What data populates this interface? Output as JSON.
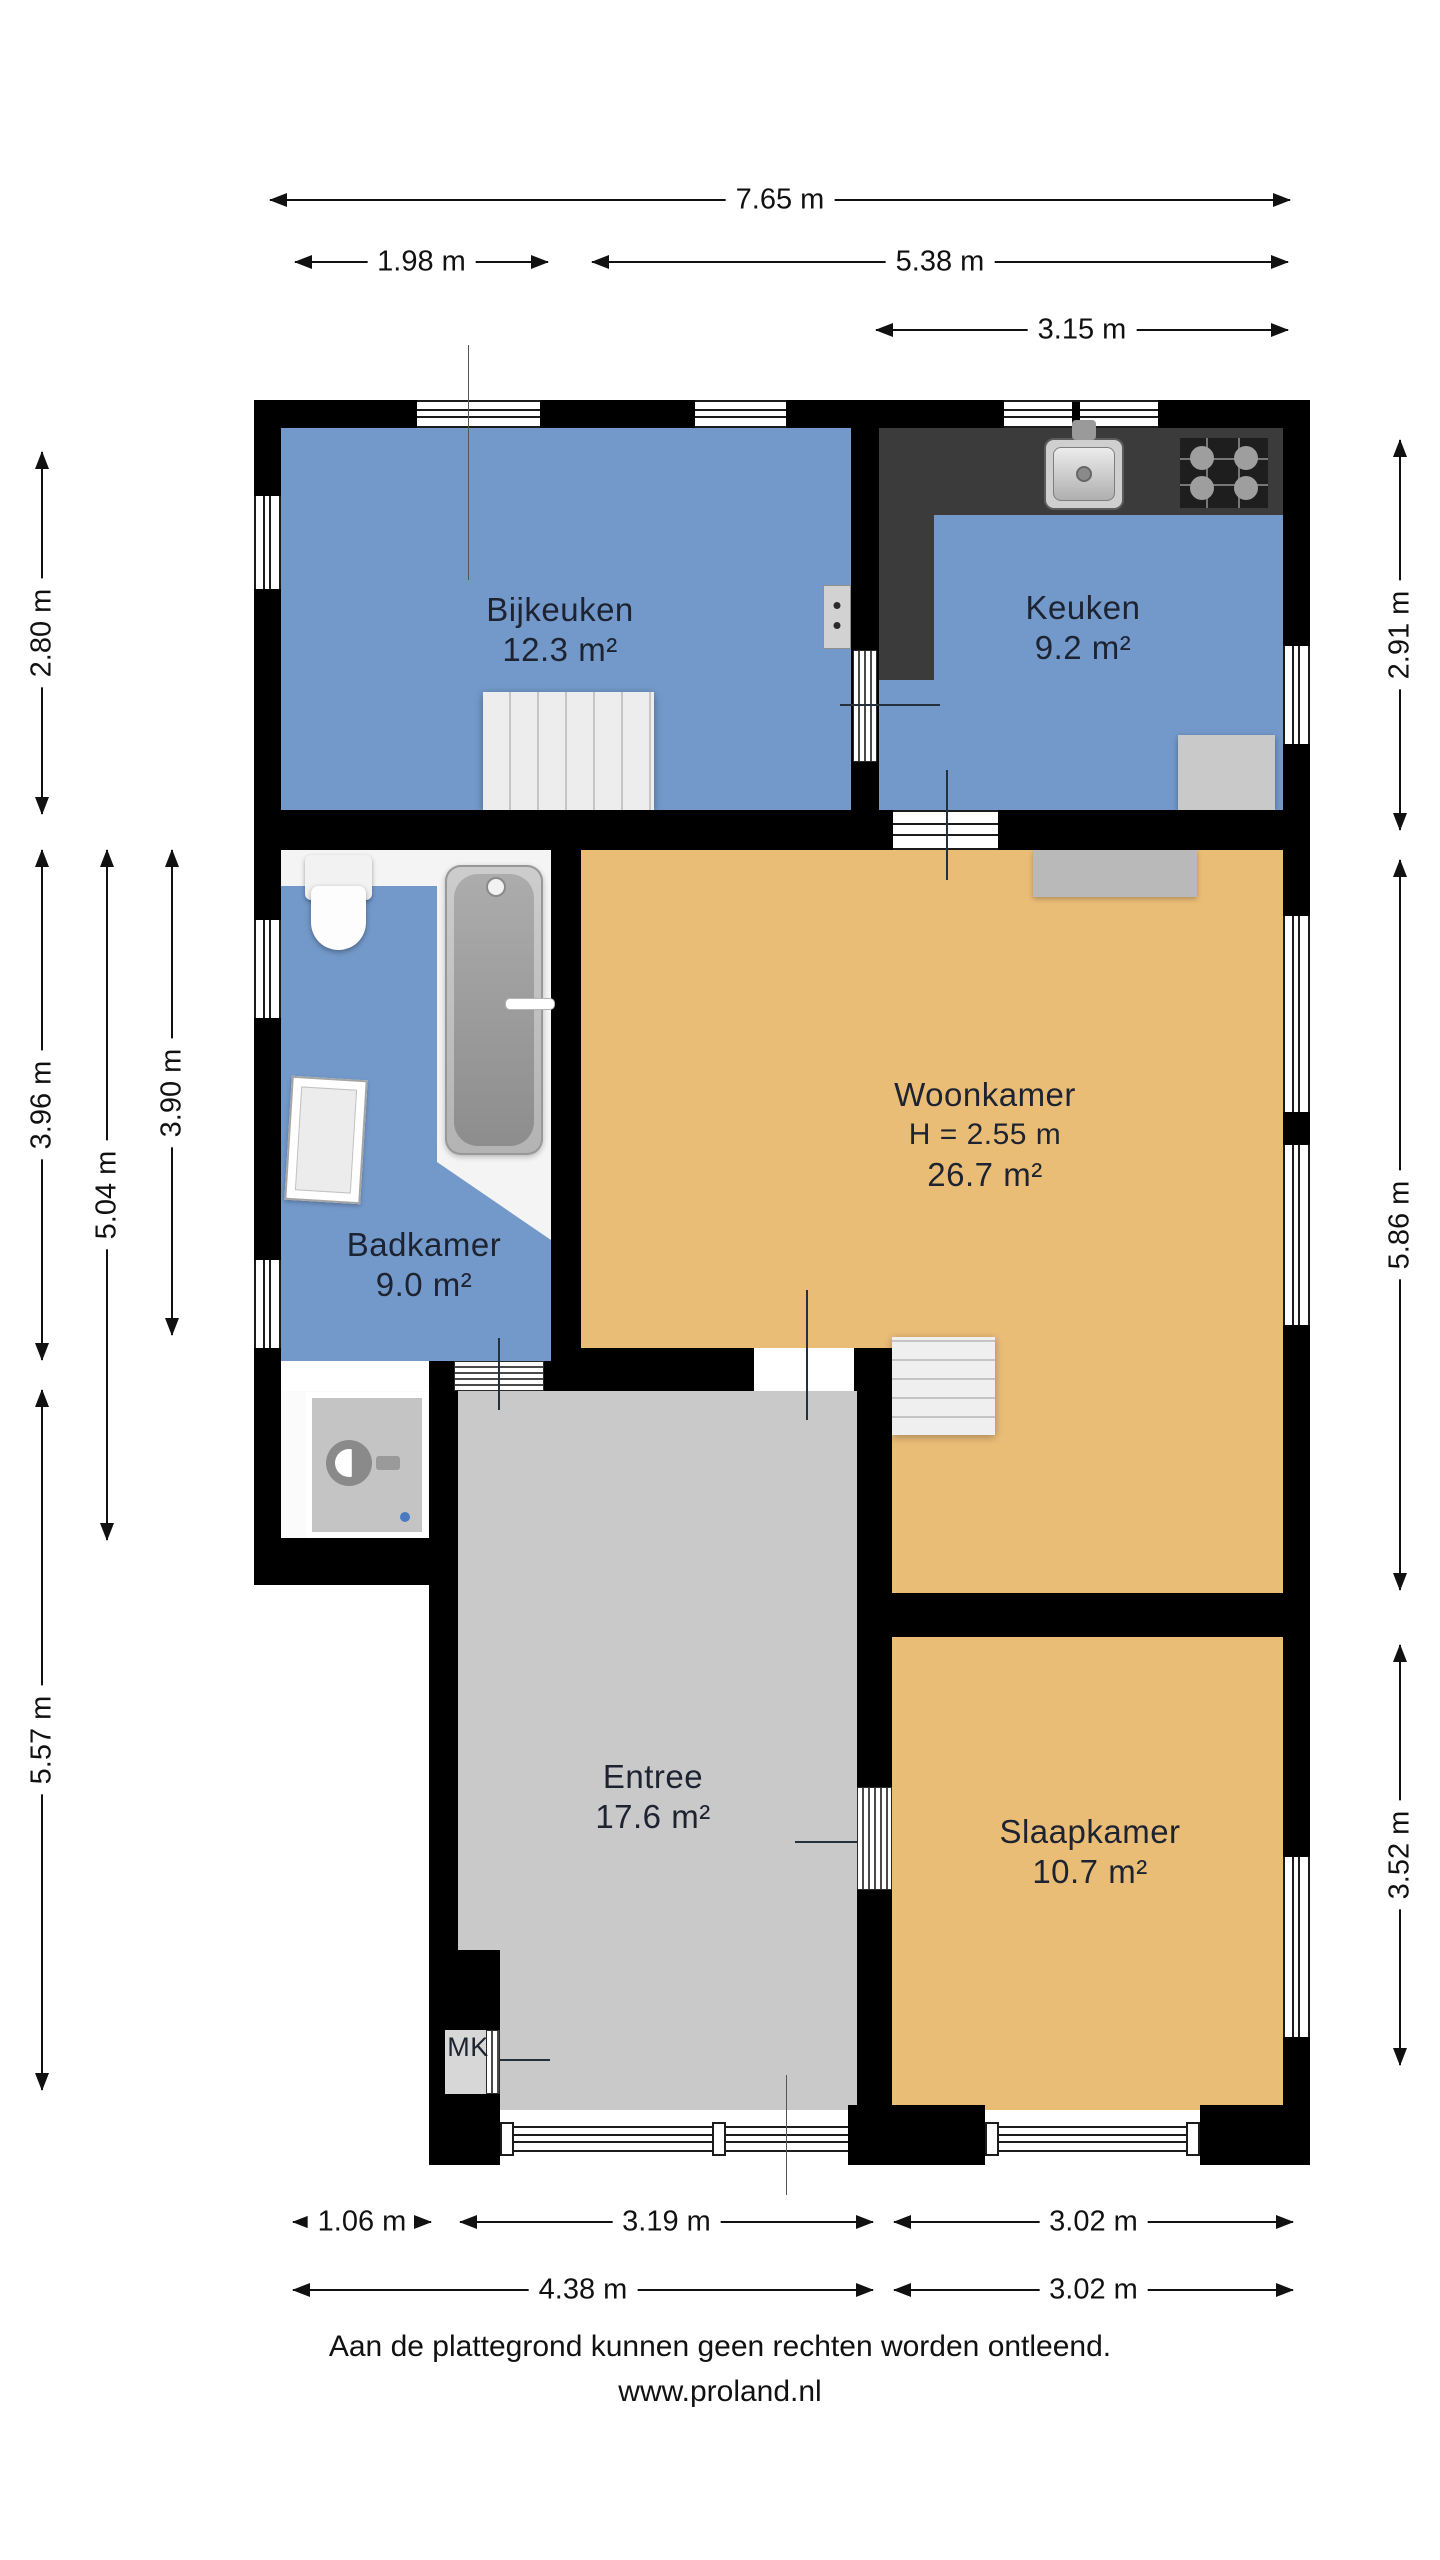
{
  "floorplan": {
    "rooms": {
      "bijkeuken": {
        "name": "Bijkeuken",
        "area": "12.3 m²"
      },
      "keuken": {
        "name": "Keuken",
        "area": "9.2 m²"
      },
      "woonkamer": {
        "name": "Woonkamer",
        "ceiling_height": "H = 2.55 m",
        "area": "26.7 m²"
      },
      "badkamer": {
        "name": "Badkamer",
        "area": "9.0 m²"
      },
      "entree": {
        "name": "Entree",
        "area": "17.6 m²"
      },
      "slaapkamer": {
        "name": "Slaapkamer",
        "area": "10.7 m²"
      },
      "meterkast": {
        "name": "MK"
      }
    },
    "dimensions": {
      "top": [
        "7.65 m",
        "1.98 m",
        "5.38 m",
        "3.15 m"
      ],
      "bottom": [
        "1.06 m",
        "3.19 m",
        "3.02 m",
        "4.38 m",
        "3.02 m"
      ],
      "left": [
        "2.80 m",
        "3.96 m",
        "5.57 m",
        "5.04 m",
        "3.90 m"
      ],
      "right": [
        "2.91 m",
        "5.86 m",
        "3.52 m"
      ]
    },
    "fixtures": [
      "staircase",
      "kitchen-sink",
      "cooktop",
      "bathtub",
      "toilet",
      "washbasin",
      "washing-machine",
      "radiator",
      "boiler"
    ],
    "colors": {
      "wet_rooms": "#7399CB",
      "living_rooms": "#EABD77",
      "hallway": "#C9C9C9",
      "walls": "#000000",
      "counter": "#3B3B3B"
    }
  },
  "footer": {
    "disclaimer": "Aan de plattegrond kunnen geen rechten worden ontleend.",
    "website": "www.proland.nl"
  }
}
